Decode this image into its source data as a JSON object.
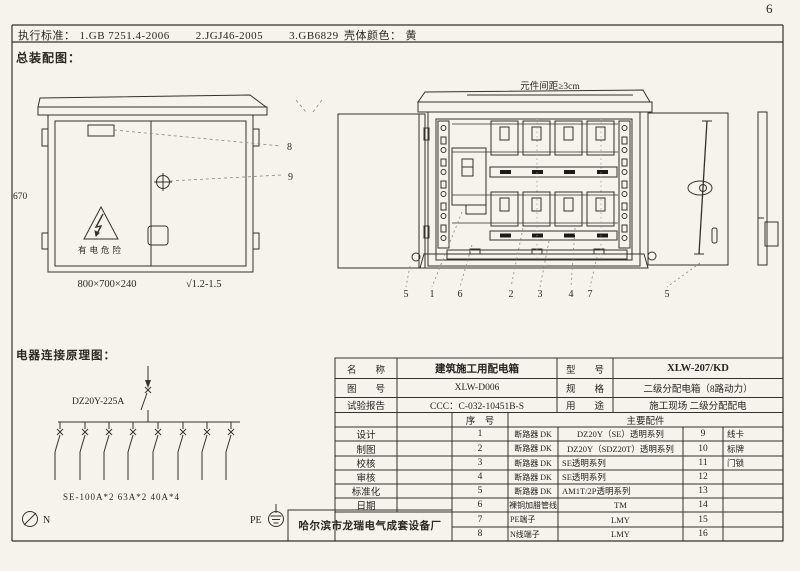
{
  "page": {
    "number": "6"
  },
  "colors": {
    "paper": "#f5f3ec",
    "ink": "#35322c",
    "accent_black": "#1c1a17"
  },
  "header": {
    "standards_label": "执行标准：",
    "standards": [
      "1.GB 7251.4-2006",
      "2.JGJ46-2005",
      "3.GB6829"
    ],
    "shell_color_label": "壳体颜色：",
    "shell_color_value": "黄"
  },
  "assembly": {
    "section_title": "总装配图：",
    "closed_cabinet": {
      "height_dim": "670",
      "size_dim": "800×700×240",
      "finish_mark": "√1.2-1.5",
      "warning_text": "有电危险",
      "callout_8": "8",
      "callout_9": "9"
    },
    "open_cabinet": {
      "spacing_note": "元件间距≥3cm",
      "callouts": [
        "5",
        "1",
        "6",
        "2",
        "3",
        "4",
        "7",
        "5"
      ]
    }
  },
  "schematic": {
    "section_title": "电器连接原理图：",
    "main_breaker": "DZ20Y-225A",
    "branch_spec": "SE-100A*2 63A*2 40A*4",
    "neutral_label": "N",
    "pe_label": "PE"
  },
  "manufacturer": "哈尔滨市龙瑞电气成套设备厂",
  "spec_table": {
    "info_rows": [
      {
        "label": "名　　称",
        "value": "建筑施工用配电箱",
        "label2": "型　　号",
        "value2": "XLW-207/KD"
      },
      {
        "label": "图　　号",
        "value": "XLW-D006",
        "label2": "规　　格",
        "value2": "二级分配电箱（8路动力）"
      },
      {
        "label": "试验报告",
        "value": "CCC：C-032-10451B-S",
        "label2": "用　　途",
        "value2": "施工现场 二级分配配电"
      }
    ],
    "header": {
      "seq": "序　号",
      "parts": "主要配件"
    },
    "sign_labels": [
      "设计",
      "制图",
      "校核",
      "审核",
      "标准化",
      "日期"
    ],
    "parts": [
      {
        "no": "1",
        "name": "断路器 DK",
        "spec": "DZ20Y（SE）透明系列",
        "no2": "9",
        "name2": "线卡"
      },
      {
        "no": "2",
        "name": "断路器 DK",
        "spec": "DZ20Y（SDZ20T）透明系列",
        "no2": "10",
        "name2": "标牌"
      },
      {
        "no": "3",
        "name": "断路器 DK",
        "spec": "SE透明系列",
        "no2": "11",
        "name2": "门锁"
      },
      {
        "no": "4",
        "name": "断路器 DK",
        "spec": "SE透明系列",
        "no2": "12",
        "name2": ""
      },
      {
        "no": "5",
        "name": "断路器 DK",
        "spec": "AM1T/2P透明系列",
        "no2": "13",
        "name2": ""
      },
      {
        "no": "6",
        "name": "裸铜加腊管线",
        "spec": "TM",
        "no2": "14",
        "name2": ""
      },
      {
        "no": "7",
        "name": "PE端子",
        "spec": "LMY",
        "no2": "15",
        "name2": ""
      },
      {
        "no": "8",
        "name": "N线端子",
        "spec": "LMY",
        "no2": "16",
        "name2": ""
      }
    ]
  }
}
